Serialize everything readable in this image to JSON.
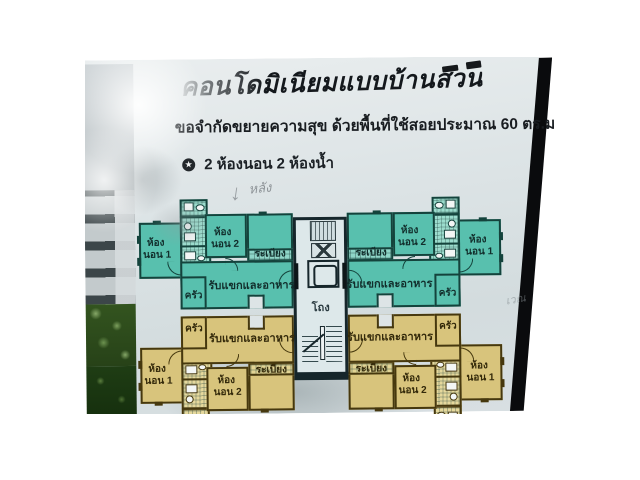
{
  "page": {
    "title": "คอนโดมิเนียมแบบบ้านสวน",
    "subtitle": "ขอจำกัดขยายความสุข ด้วยพื้นที่ใช้สอยประมาณ 60 ตร.ม.",
    "feature_bullet": "★",
    "features": "2 ห้องนอน 2 ห้องน้ำ",
    "handwriting": {
      "top_note": "หลัง",
      "top_arrow": "↓",
      "right_note": "เวณ"
    },
    "floorplan": {
      "hall": "โถง",
      "labels": {
        "bedroom1_l1": "ห้อง",
        "bedroom1_l2": "นอน 1",
        "bedroom2_l1": "ห้อง",
        "bedroom2_l2": "นอน 2",
        "balcony": "ระเบียง",
        "living": "รับแขกและอาหาร",
        "kitchen": "ครัว"
      }
    },
    "colors": {
      "teal_unit": "#58c0ae",
      "yellow_unit": "#d8c47c",
      "paper": "#dce3e5",
      "photo_background": "#0a0b0d"
    }
  }
}
